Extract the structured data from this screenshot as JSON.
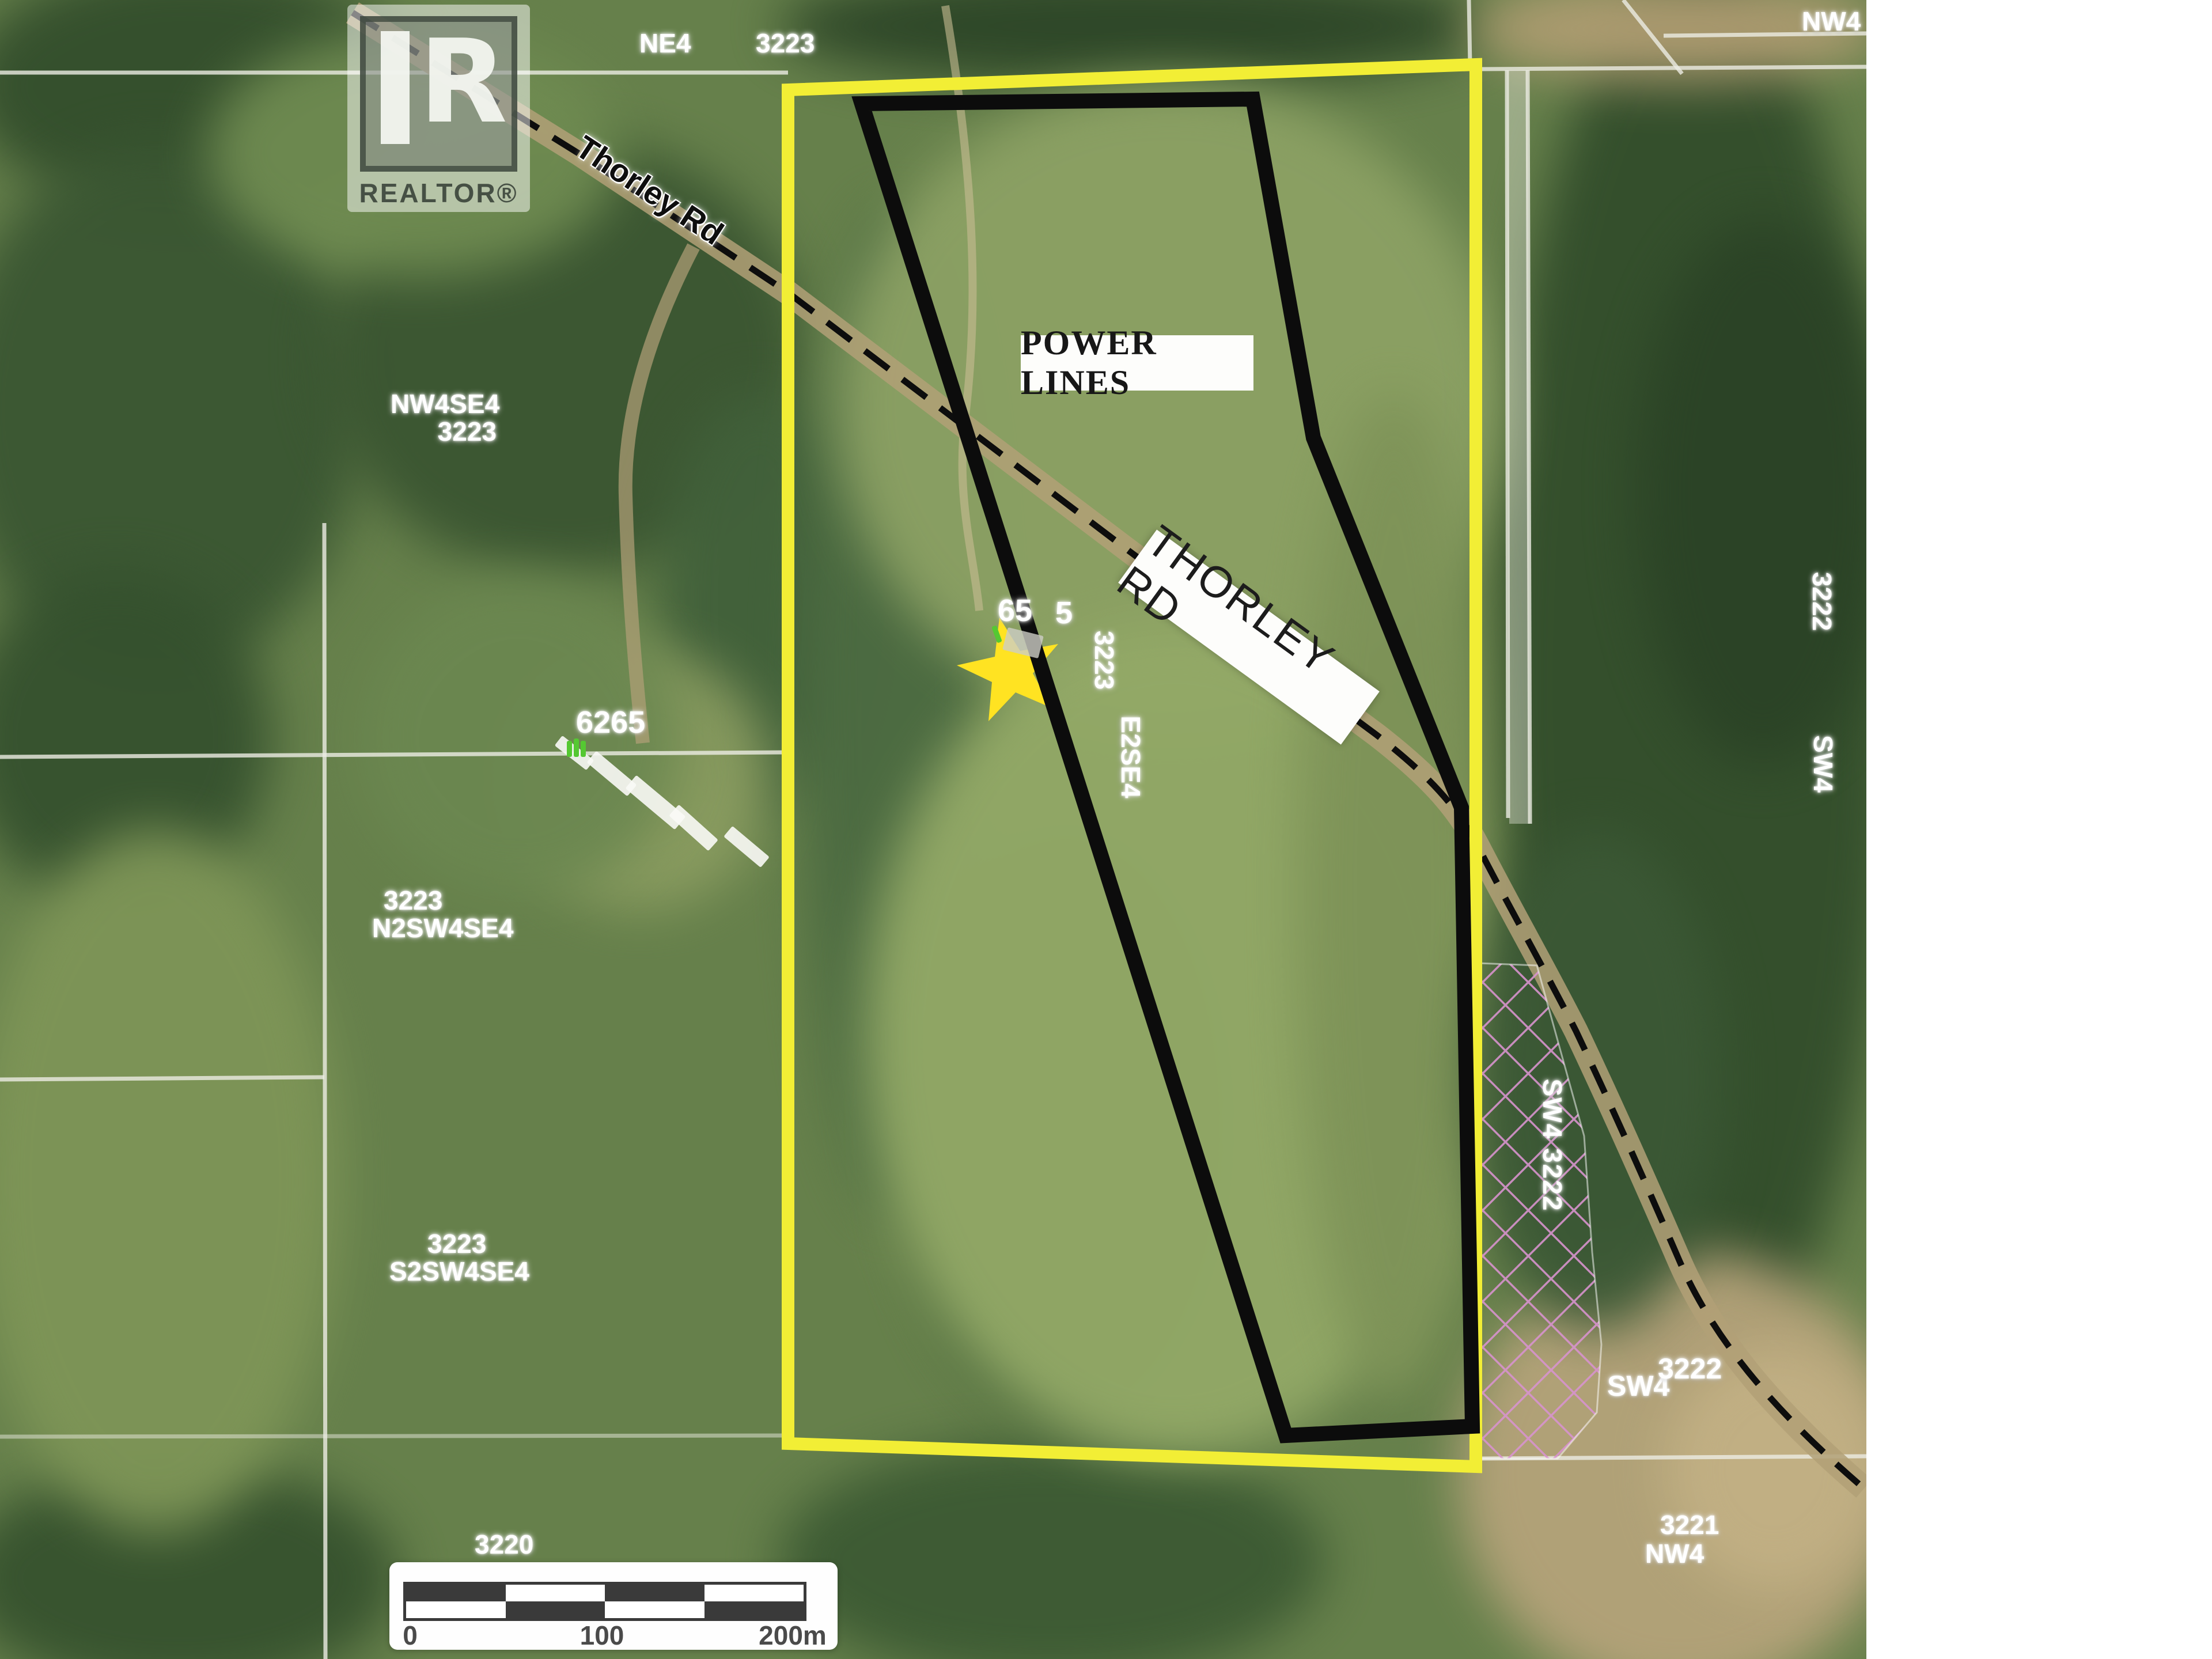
{
  "watermark": {
    "logo_letter": "R",
    "brand": "REALTOR®"
  },
  "road_labels": {
    "thorley_small": "Thorley Rd",
    "thorley_sign": "THORLEY RD"
  },
  "overlays": {
    "power_lines": "POWER LINES"
  },
  "markers": {
    "subject_address_left": "65",
    "subject_address_right": "5",
    "neighbor_address": "6265"
  },
  "parcels": {
    "ne4": "NE4",
    "sec_top": "3223",
    "top_right": "NW4",
    "nw4se4_line1": "NW4SE4",
    "nw4se4_line2": "3223",
    "n2_line1": "3223",
    "n2_line2": "N2SW4SE4",
    "s2_line1": "3223",
    "s2_line2": "S2SW4SE4",
    "sec_3220": "3220",
    "vert_3223": "3223",
    "vert_e2se4": "E2SE4",
    "vert_sw4_3222": "SW4 3222",
    "bottom_quarter": "SW4",
    "bottom_sec": "3222",
    "se_sec": "3221",
    "se_quarter": "NW4",
    "right_sec": "3222",
    "right_quarter": "SW4"
  },
  "scalebar": {
    "t0": "0",
    "t100": "100",
    "t200": "200m"
  },
  "colors": {
    "boundary_yellow": "#f2ee35",
    "boundary_black": "#0c0c0c",
    "hatch_pink": "#d893cd",
    "star_yellow": "#ffe322",
    "label_white": "#ffffff"
  }
}
